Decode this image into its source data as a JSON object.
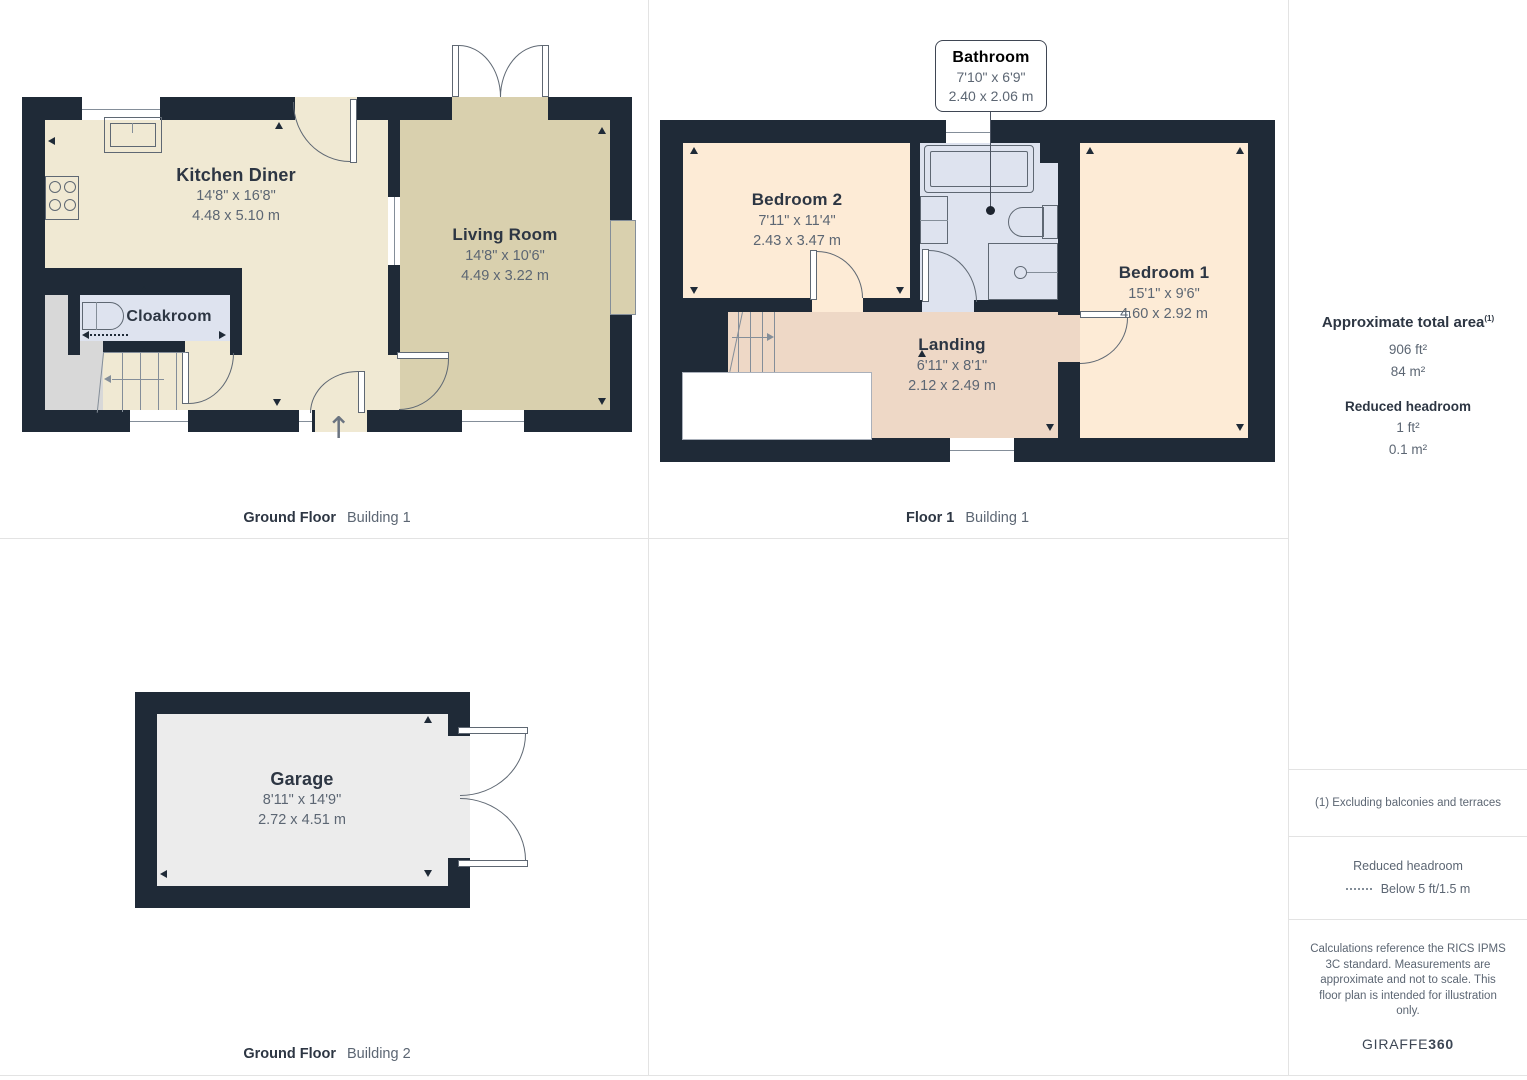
{
  "panels": [
    {
      "caption_bold": "Ground Floor",
      "caption_light": "Building 1",
      "rooms": [
        {
          "name": "Kitchen Diner",
          "imperial": "14'8\" x 16'8\"",
          "metric": "4.48 x 5.10 m"
        },
        {
          "name": "Living Room",
          "imperial": "14'8\" x 10'6\"",
          "metric": "4.49 x 3.22 m"
        },
        {
          "name": "Cloakroom"
        }
      ]
    },
    {
      "caption_bold": "Floor 1",
      "caption_light": "Building 1",
      "callout": {
        "name": "Bathroom",
        "imperial": "7'10\" x 6'9\"",
        "metric": "2.40 x 2.06 m"
      },
      "rooms": [
        {
          "name": "Bedroom 2",
          "imperial": "7'11\" x 11'4\"",
          "metric": "2.43 x 3.47 m"
        },
        {
          "name": "Bedroom 1",
          "imperial": "15'1\" x 9'6\"",
          "metric": "4.60 x 2.92 m"
        },
        {
          "name": "Landing",
          "imperial": "6'11\" x 8'1\"",
          "metric": "2.12 x 2.49 m"
        }
      ]
    },
    {
      "caption_bold": "Ground Floor",
      "caption_light": "Building 2",
      "rooms": [
        {
          "name": "Garage",
          "imperial": "8'11\" x 14'9\"",
          "metric": "2.72 x 4.51 m"
        }
      ]
    }
  ],
  "sidebar": {
    "total_area_label": "Approximate total area",
    "total_area_footnote_mark": "(1)",
    "total_area_ft": "906 ft²",
    "total_area_m": "84 m²",
    "reduced_headroom_label": "Reduced headroom",
    "reduced_ft": "1 ft²",
    "reduced_m": "0.1 m²",
    "footnote": "(1) Excluding balconies and terraces",
    "legend_title": "Reduced headroom",
    "legend_item": "Below 5 ft/1.5 m",
    "disclaimer": "Calculations reference the RICS IPMS 3C standard. Measurements are approximate and not to scale. This floor plan is intended for illustration only.",
    "brand_regular": "GIRAFFE",
    "brand_bold": "360"
  },
  "icons": {
    "entrance_arrow": "↑"
  },
  "colors": {
    "wall": "#1f2a37",
    "cream": "#f0e9d3",
    "tan": "#d9d0ae",
    "blue": "#dee3ef",
    "peach": "#fdebd6",
    "salmon": "#eed8c6",
    "lgray": "#ececec",
    "dgray": "#d8d8d8",
    "line": "#5f6873",
    "linesoft": "#848e99",
    "tdark": "#2d3643",
    "tgray": "#5c6673",
    "border": "#e3e3e3"
  }
}
